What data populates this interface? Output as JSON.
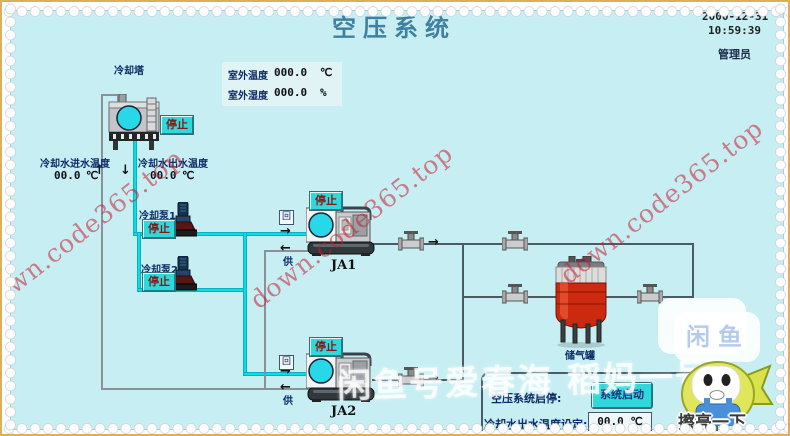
{
  "header": {
    "title": "空压系统",
    "date": "2000-12-31",
    "time": "10:59:39",
    "user": "管理员"
  },
  "outdoor": {
    "temp_label": "室外温度",
    "temp_value": "000.0",
    "temp_unit": "℃",
    "hum_label": "室外湿度",
    "hum_value": "000.0",
    "hum_unit": "%"
  },
  "tower": {
    "label": "冷却塔",
    "stop": "停止"
  },
  "water": {
    "inlet_label": "冷却水进水温度",
    "inlet_value": "00.0",
    "inlet_unit": "℃",
    "outlet_label": "冷却水出水温度",
    "outlet_value": "00.0",
    "outlet_unit": "℃"
  },
  "pumps": {
    "pump1_label": "冷却泵1",
    "pump1_stop": "停止",
    "pump2_label": "冷却泵2",
    "pump2_stop": "停止"
  },
  "compressors": {
    "ja1_label": "JA1",
    "ja1_stop": "停止",
    "ja2_label": "JA2",
    "ja2_stop": "停止",
    "supply_tag": "回",
    "return_tag": "供"
  },
  "tank": {
    "label": "储气罐"
  },
  "panel": {
    "onoff_label": "空压系统启停:",
    "start_button": "系统启动",
    "setting_label": "冷却水出水温度设定:",
    "setting_value": "00.0 ℃"
  },
  "icons": {
    "arrow_up": "↑",
    "arrow_down": "↓",
    "arrow_left": "←",
    "arrow_right": "→"
  },
  "watermark": {
    "diagonal": "down.code365.top",
    "seller": "闲鱼号爱春海 稻妈一号",
    "logo": "闲鱼",
    "badge": "擦亮一下"
  },
  "colors": {
    "screen_bg": "#c7eff3",
    "accent_cyan": "#30d8dc",
    "pipe_cyan": "#0cdce8",
    "tank_red": "#cc2a10",
    "watermark_red": "#c91c2d",
    "text_navy": "#0d2a66"
  }
}
